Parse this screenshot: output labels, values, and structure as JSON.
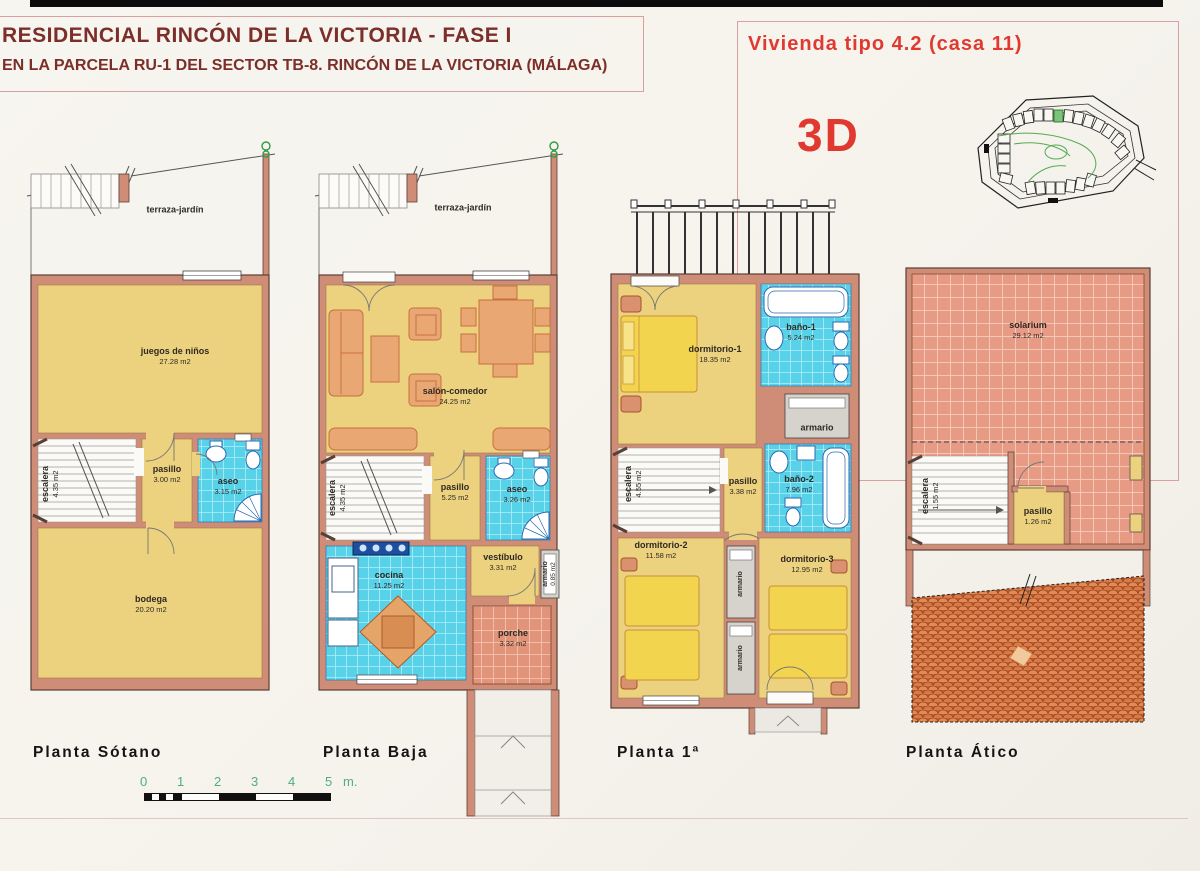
{
  "header": {
    "title_line1": "RESIDENCIAL  RINCÓN DE LA VICTORIA - FASE I",
    "title_line2": "EN LA PARCELA RU-1 DEL SECTOR TB-8. RINCÓN DE LA VICTORIA (MÁLAGA)",
    "unit_label": "Vivienda tipo 4.2 (casa 11)",
    "view_label": "3D"
  },
  "plans": [
    {
      "name": "Planta Sótano",
      "rooms": [
        {
          "label": "terraza-jardín"
        },
        {
          "label": "juegos de niños",
          "area": "27.28 m2"
        },
        {
          "label": "escalera",
          "area": "4.35 m2"
        },
        {
          "label": "pasillo",
          "area": "3.00 m2"
        },
        {
          "label": "aseo",
          "area": "3.15 m2"
        },
        {
          "label": "bodega",
          "area": "20.20 m2"
        }
      ]
    },
    {
      "name": "Planta Baja",
      "rooms": [
        {
          "label": "terraza-jardín"
        },
        {
          "label": "salón-comedor",
          "area": "24.25 m2"
        },
        {
          "label": "escalera",
          "area": "4.35 m2"
        },
        {
          "label": "pasillo",
          "area": "5.25 m2"
        },
        {
          "label": "aseo",
          "area": "3.26 m2"
        },
        {
          "label": "cocina",
          "area": "11.25 m2"
        },
        {
          "label": "vestíbulo",
          "area": "3.31 m2"
        },
        {
          "label": "armario",
          "area": "0.85 m2"
        },
        {
          "label": "porche",
          "area": "3.32 m2"
        }
      ]
    },
    {
      "name": "Planta 1ª",
      "rooms": [
        {
          "label": "dormitorio-1",
          "area": "18.35 m2"
        },
        {
          "label": "baño-1",
          "area": "5.24 m2"
        },
        {
          "label": "armario"
        },
        {
          "label": "escalera",
          "area": "4.55 m2"
        },
        {
          "label": "pasillo",
          "area": "3.38 m2"
        },
        {
          "label": "baño-2",
          "area": "7.96 m2"
        },
        {
          "label": "dormitorio-2",
          "area": "11.58 m2"
        },
        {
          "label": "armario"
        },
        {
          "label": "armario"
        },
        {
          "label": "dormitorio-3",
          "area": "12.95 m2"
        }
      ]
    },
    {
      "name": "Planta Ático",
      "rooms": [
        {
          "label": "solarium",
          "area": "29.12 m2"
        },
        {
          "label": "escalera",
          "area": "1.55 m2"
        },
        {
          "label": "pasillo",
          "area": "1.26 m2"
        }
      ]
    }
  ],
  "scale_bar": {
    "ticks": [
      "0",
      "1",
      "2",
      "3",
      "4",
      "5"
    ],
    "unit": "m."
  },
  "colors": {
    "accent_red": "#e03a30",
    "title_maroon": "#7c2e29",
    "wall": "#cf8c76",
    "room_yellow": "#ecd17e",
    "tile_blue": "#58d2e8",
    "tile_terracotta": "#e2947a",
    "scale_green": "#4fae7e"
  }
}
